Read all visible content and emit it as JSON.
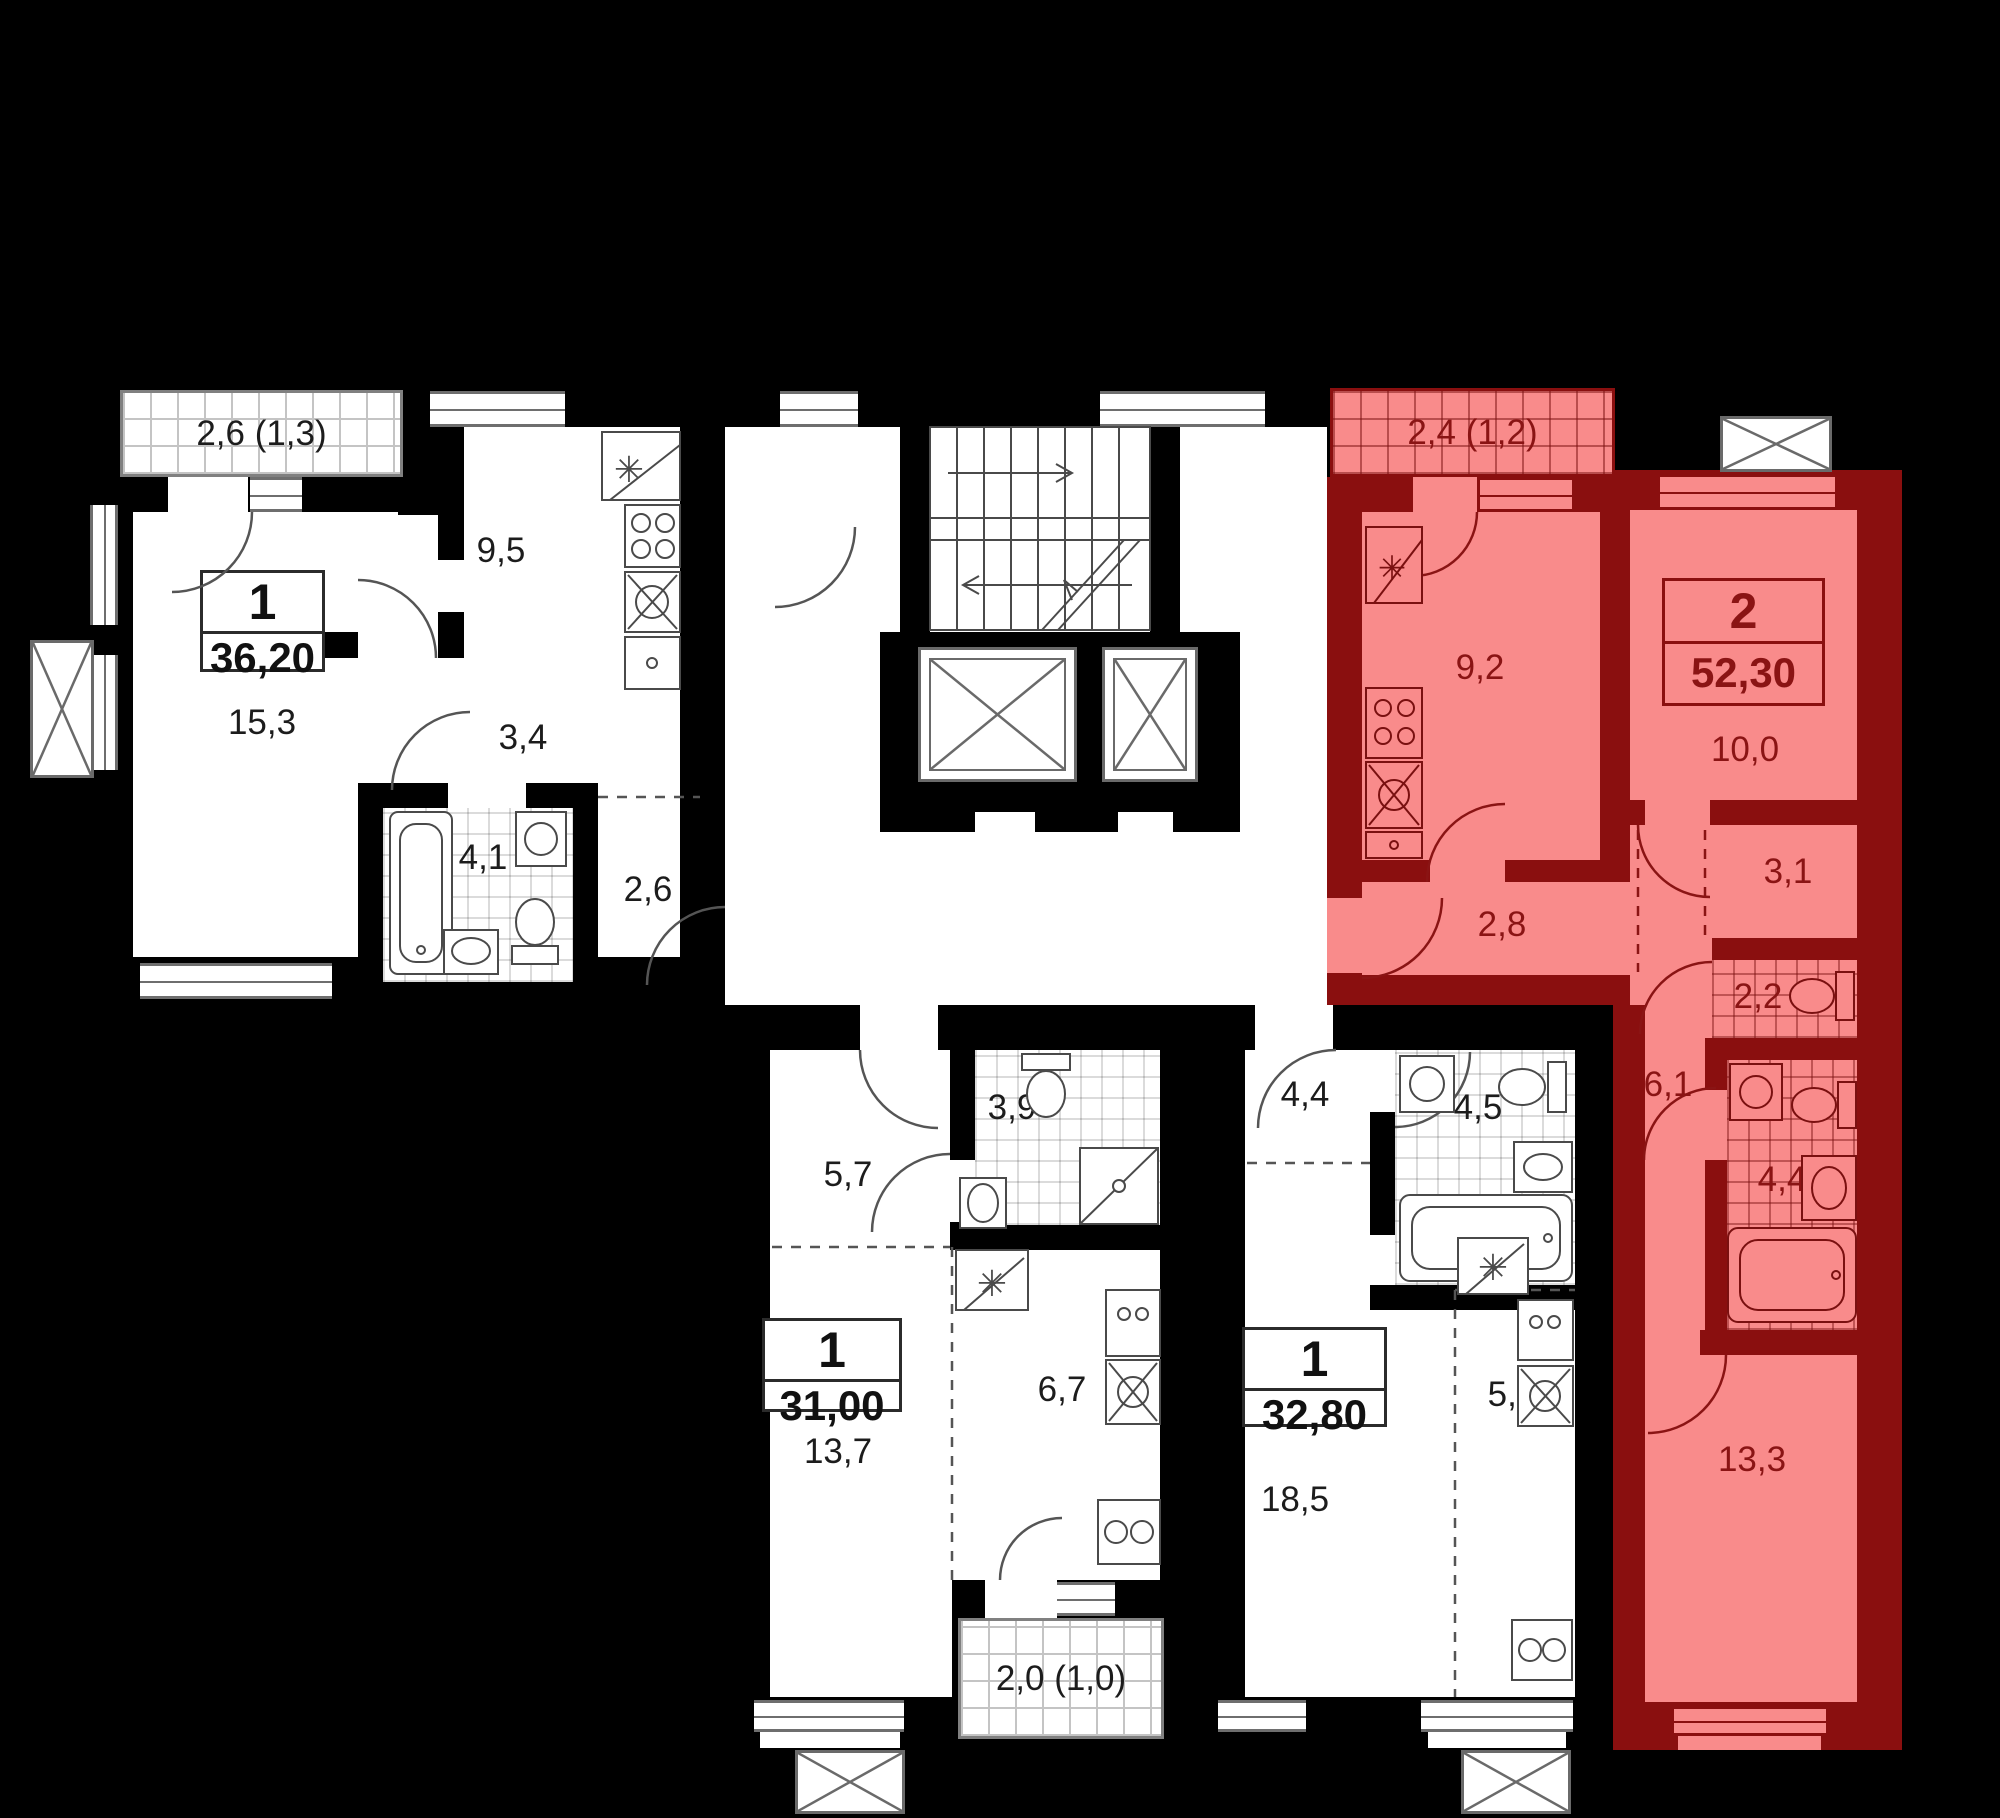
{
  "colors": {
    "background": "#000000",
    "wall": "#000000",
    "floor": "#ffffff",
    "selected_fill": "#f98b8b",
    "selected_wall": "#8a0f0f",
    "selected_text": "#8a1414",
    "label_text": "#1c1c1c"
  },
  "apartments": [
    {
      "name": "apartment-36-20",
      "rooms_count": "1",
      "total_area": "36,20",
      "selected": false,
      "balcony_area": "2,6 (1,3)",
      "rooms": [
        {
          "name": "living-room",
          "area": "15,3"
        },
        {
          "name": "kitchen",
          "area": "9,5"
        },
        {
          "name": "corridor",
          "area": "3,4"
        },
        {
          "name": "bathroom",
          "area": "4,1"
        },
        {
          "name": "hall",
          "area": "2,6"
        }
      ]
    },
    {
      "name": "apartment-52-30",
      "rooms_count": "2",
      "total_area": "52,30",
      "selected": true,
      "balcony_area": "2,4 (1,2)",
      "rooms": [
        {
          "name": "kitchen",
          "area": "9,2"
        },
        {
          "name": "living-room",
          "area": "10,0"
        },
        {
          "name": "hall",
          "area": "2,8"
        },
        {
          "name": "wardrobe",
          "area": "3,1"
        },
        {
          "name": "wc",
          "area": "2,2"
        },
        {
          "name": "hallway",
          "area": "6,1"
        },
        {
          "name": "bathroom",
          "area": "4,4"
        },
        {
          "name": "bedroom",
          "area": "13,3"
        }
      ]
    },
    {
      "name": "apartment-31-00",
      "rooms_count": "1",
      "total_area": "31,00",
      "selected": false,
      "balcony_area": "2,0 (1,0)",
      "rooms": [
        {
          "name": "hall",
          "area": "5,7"
        },
        {
          "name": "bathroom",
          "area": "3,9"
        },
        {
          "name": "living-room",
          "area": "13,7"
        },
        {
          "name": "kitchen",
          "area": "6,7"
        }
      ]
    },
    {
      "name": "apartment-32-80",
      "rooms_count": "1",
      "total_area": "32,80",
      "selected": false,
      "rooms": [
        {
          "name": "hall",
          "area": "4,4"
        },
        {
          "name": "bathroom",
          "area": "4,5"
        },
        {
          "name": "living-room",
          "area": "18,5"
        },
        {
          "name": "kitchen",
          "area": "5,4"
        }
      ]
    }
  ]
}
